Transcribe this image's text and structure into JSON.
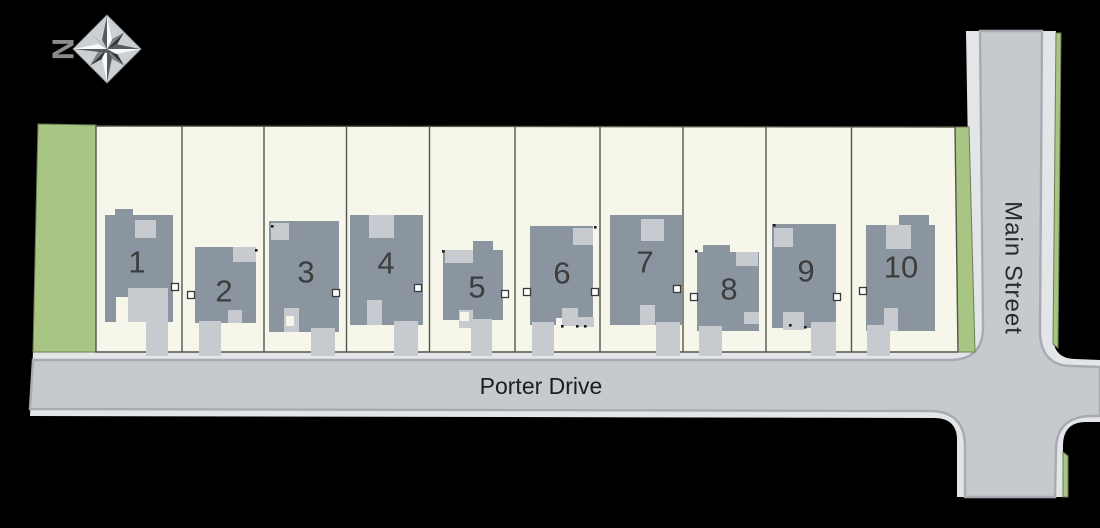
{
  "plan": {
    "type": "subdivision-site-plan",
    "lot_count": "10"
  },
  "compass": {
    "icon": "compass-rose-icon",
    "north_label": "N"
  },
  "streets": {
    "bottom_road": "Porter Drive",
    "right_road": "Main Street"
  },
  "lots": [
    {
      "number": "1"
    },
    {
      "number": "2"
    },
    {
      "number": "3"
    },
    {
      "number": "4"
    },
    {
      "number": "5"
    },
    {
      "number": "6"
    },
    {
      "number": "7"
    },
    {
      "number": "8"
    },
    {
      "number": "9"
    },
    {
      "number": "10"
    }
  ],
  "colors": {
    "background": "#000000",
    "lot_fill": "#f6f6eb",
    "greenspace": "#a9c584",
    "house": "#8a95a0",
    "hardscape": "#c7cbd0",
    "road_surface": "#c6c9ce",
    "road_edge": "#e3e5e8",
    "curb_line": "#a8acb2",
    "boundary_line": "#54554c",
    "label_text": "#1d1d1d",
    "lot_number_text": "#3d3d3d",
    "compass_letter": "#8b8b8b"
  }
}
